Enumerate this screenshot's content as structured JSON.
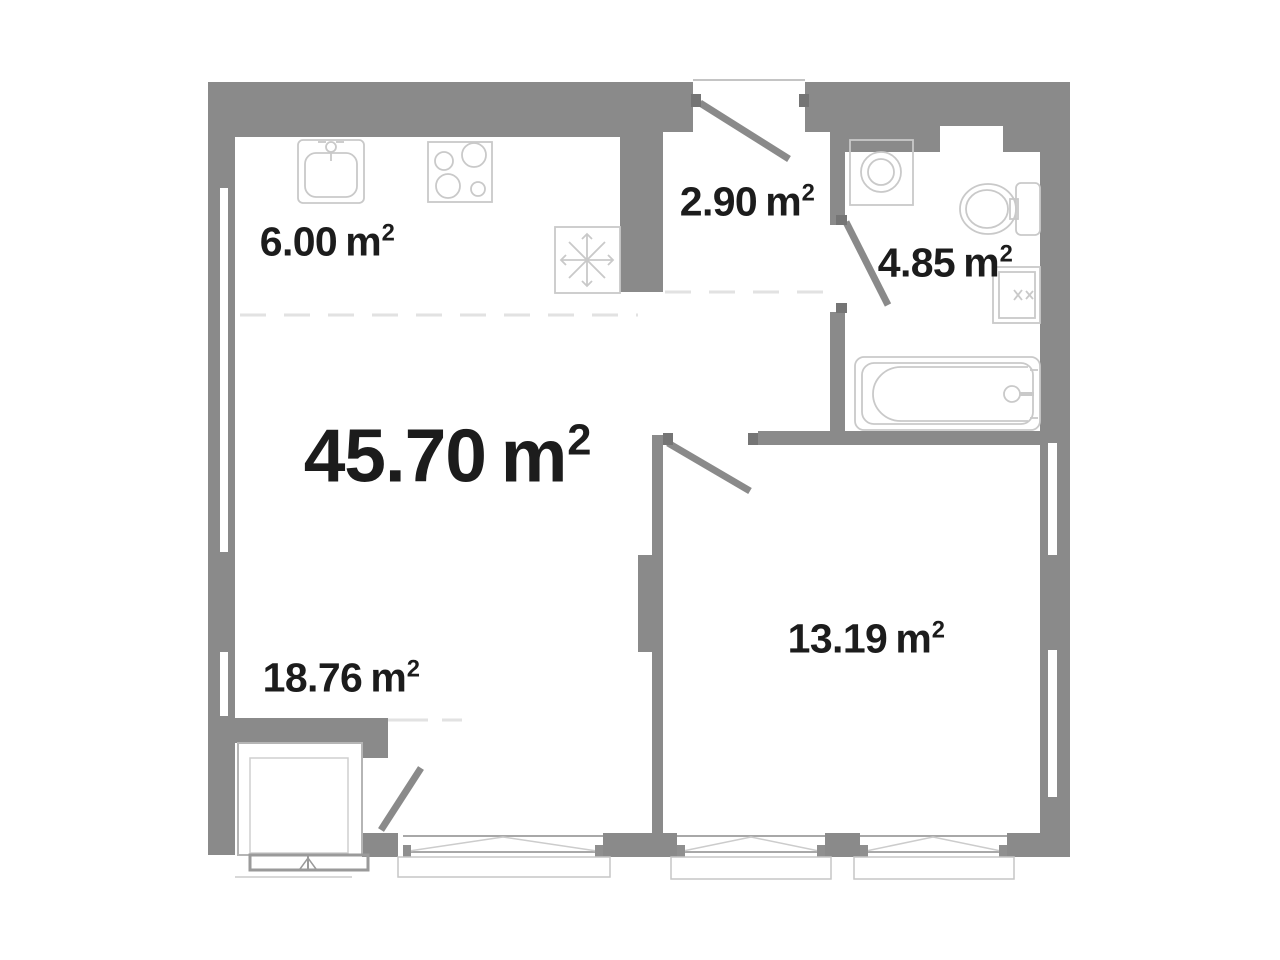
{
  "plan": {
    "type": "apartment-floor-plan",
    "colors": {
      "background": "#ffffff",
      "wall": "#8a8a8a",
      "door_leaf": "#8a8a8a",
      "fixture_outline": "#c9c9c9",
      "window_frame": "#a8a8a8",
      "dashed_boundary": "#e2e2e2",
      "jamb_mark": "#757575",
      "text": "#1c1c1c"
    },
    "labels": {
      "total": {
        "value": "45.70",
        "unit": "m",
        "exp": "2"
      },
      "kitchen": {
        "value": "6.00",
        "unit": "m",
        "exp": "2"
      },
      "hall": {
        "value": "2.90",
        "unit": "m",
        "exp": "2"
      },
      "bath": {
        "value": "4.85",
        "unit": "m",
        "exp": "2"
      },
      "living": {
        "value": "18.76",
        "unit": "m",
        "exp": "2"
      },
      "bedroom": {
        "value": "13.19",
        "unit": "m",
        "exp": "2"
      }
    }
  }
}
